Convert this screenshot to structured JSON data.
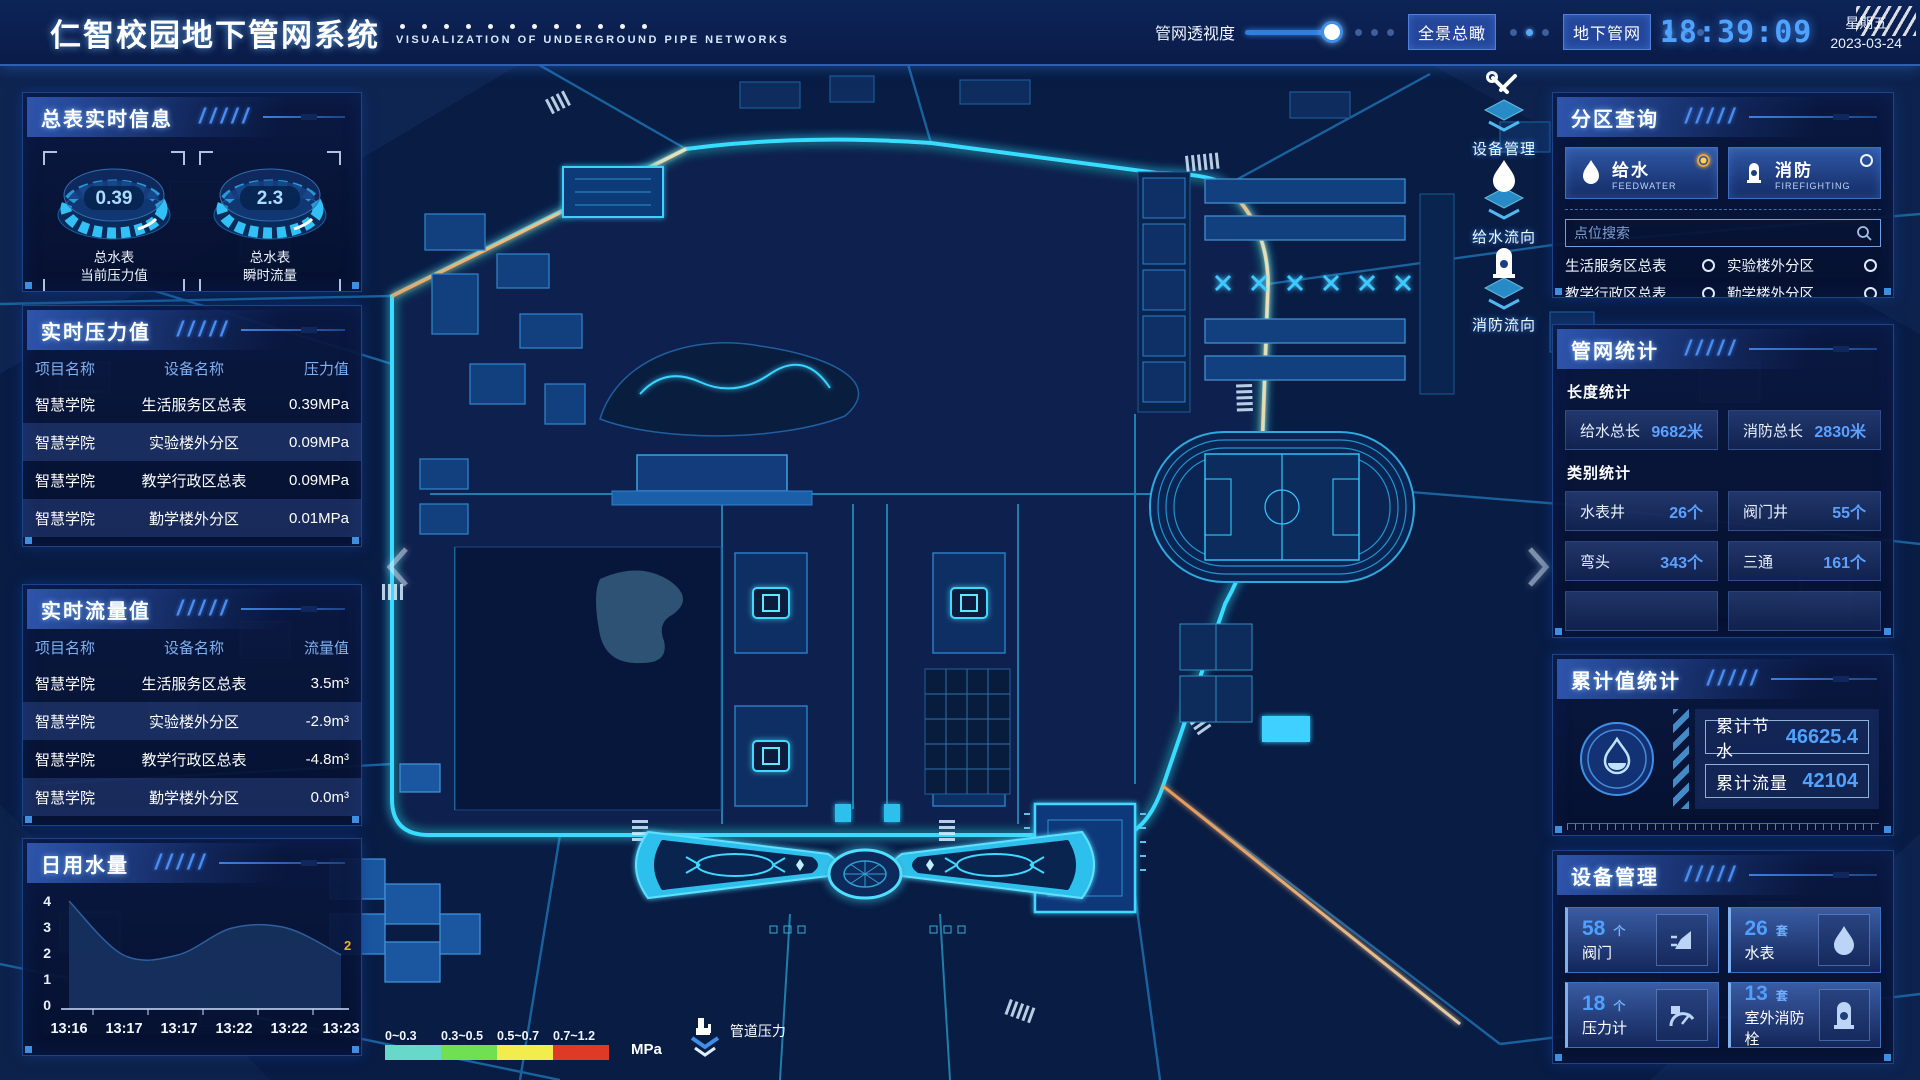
{
  "header": {
    "title_zh": "仁智校园地下管网系统",
    "title_en": "VISUALIZATION OF UNDERGROUND PIPE NETWORKS",
    "slider_label": "管网透视度",
    "buttons": [
      {
        "label": "全景总瞰"
      },
      {
        "label": "地下管网"
      }
    ],
    "clock": {
      "time": "18:39:09",
      "weekday": "星期五",
      "date": "2023-03-24"
    }
  },
  "left": {
    "meter_panel": {
      "title": "总表实时信息",
      "gauges": [
        {
          "value": "0.39",
          "caption1": "总水表",
          "caption2": "当前压力值"
        },
        {
          "value": "2.3",
          "caption1": "总水表",
          "caption2": "瞬时流量"
        }
      ]
    },
    "pressure_panel": {
      "title": "实时压力值",
      "columns": [
        "项目名称",
        "设备名称",
        "压力值"
      ],
      "rows": [
        [
          "智慧学院",
          "生活服务区总表",
          "0.39MPa"
        ],
        [
          "智慧学院",
          "实验楼外分区",
          "0.09MPa"
        ],
        [
          "智慧学院",
          "教学行政区总表",
          "0.09MPa"
        ],
        [
          "智慧学院",
          "勤学楼外分区",
          "0.01MPa"
        ],
        [
          "智慧学院",
          "砺学楼外分区",
          "0.00MPa"
        ]
      ]
    },
    "flow_panel": {
      "title": "实时流量值",
      "columns": [
        "项目名称",
        "设备名称",
        "流量值"
      ],
      "rows": [
        [
          "智慧学院",
          "生活服务区总表",
          "3.5m³"
        ],
        [
          "智慧学院",
          "实验楼外分区",
          "-2.9m³"
        ],
        [
          "智慧学院",
          "教学行政区总表",
          "-4.8m³"
        ],
        [
          "智慧学院",
          "勤学楼外分区",
          "0.0m³"
        ],
        [
          "智慧学院",
          "砺学楼外分区",
          "2.3m³"
        ]
      ]
    },
    "daily_panel": {
      "title": "日用水量"
    }
  },
  "right": {
    "zone_panel": {
      "title": "分区查询",
      "tabs": [
        {
          "zh": "给水",
          "en": "FEEDWATER",
          "selected": true
        },
        {
          "zh": "消防",
          "en": "FIREFIGHTING",
          "selected": false
        }
      ],
      "search_placeholder": "点位搜索",
      "items": [
        "生活服务区总表",
        "实验楼外分区",
        "教学行政区总表",
        "勤学楼外分区",
        "砺学楼外分区",
        "宿舍区泵房"
      ]
    },
    "stats_panel": {
      "title": "管网统计",
      "length_title": "长度统计",
      "length_stats": [
        {
          "label": "给水总长",
          "value": "9682米"
        },
        {
          "label": "消防总长",
          "value": "2830米"
        }
      ],
      "category_title": "类别统计",
      "category_stats": [
        {
          "label": "水表井",
          "value": "26个"
        },
        {
          "label": "阀门井",
          "value": "55个"
        },
        {
          "label": "弯头",
          "value": "343个"
        },
        {
          "label": "三通",
          "value": "161个"
        }
      ]
    },
    "total_panel": {
      "title": "累计值统计",
      "items": [
        {
          "label": "累计节水",
          "value": "46625.4"
        },
        {
          "label": "累计流量",
          "value": "42104"
        }
      ]
    },
    "device_panel": {
      "title": "设备管理",
      "cards": [
        {
          "count": "58",
          "unit": "个",
          "label": "阀门",
          "icon": "valve-icon"
        },
        {
          "count": "26",
          "unit": "套",
          "label": "水表",
          "icon": "water-meter-icon"
        },
        {
          "count": "18",
          "unit": "个",
          "label": "压力计",
          "icon": "pressure-gauge-icon"
        },
        {
          "count": "13",
          "unit": "套",
          "label": "室外消防栓",
          "icon": "hydrant-icon"
        }
      ]
    }
  },
  "map": {
    "legend": {
      "ranges": [
        {
          "label": "0~0.3",
          "color": "#66d9cb"
        },
        {
          "label": "0.3~0.5",
          "color": "#70e052"
        },
        {
          "label": "0.5~0.7",
          "color": "#f2ed4d"
        },
        {
          "label": "0.7~1.2",
          "color": "#df3a26"
        }
      ],
      "unit": "MPa",
      "meter_label": "管道压力"
    },
    "tools": [
      {
        "label": "设备管理",
        "icon": "wrench-icon"
      },
      {
        "label": "给水流向",
        "icon": "water-drop-icon"
      },
      {
        "label": "消防流向",
        "icon": "hydrant-icon"
      }
    ]
  },
  "chart_data": {
    "type": "area",
    "title": "日用水量",
    "x": [
      "13:16",
      "13:17",
      "13:17",
      "13:22",
      "13:22",
      "13:23"
    ],
    "values": [
      4,
      2,
      2,
      3,
      3,
      2
    ],
    "yticks": [
      4,
      3,
      2,
      1,
      0
    ],
    "ylim": [
      0,
      4
    ],
    "xlabel": "",
    "ylabel": "",
    "grid": false,
    "legend_position": "none",
    "end_label": "2",
    "end_label_color": "#e8b33a",
    "area_color": "#16305e",
    "line_color": "#2f5f9f"
  }
}
